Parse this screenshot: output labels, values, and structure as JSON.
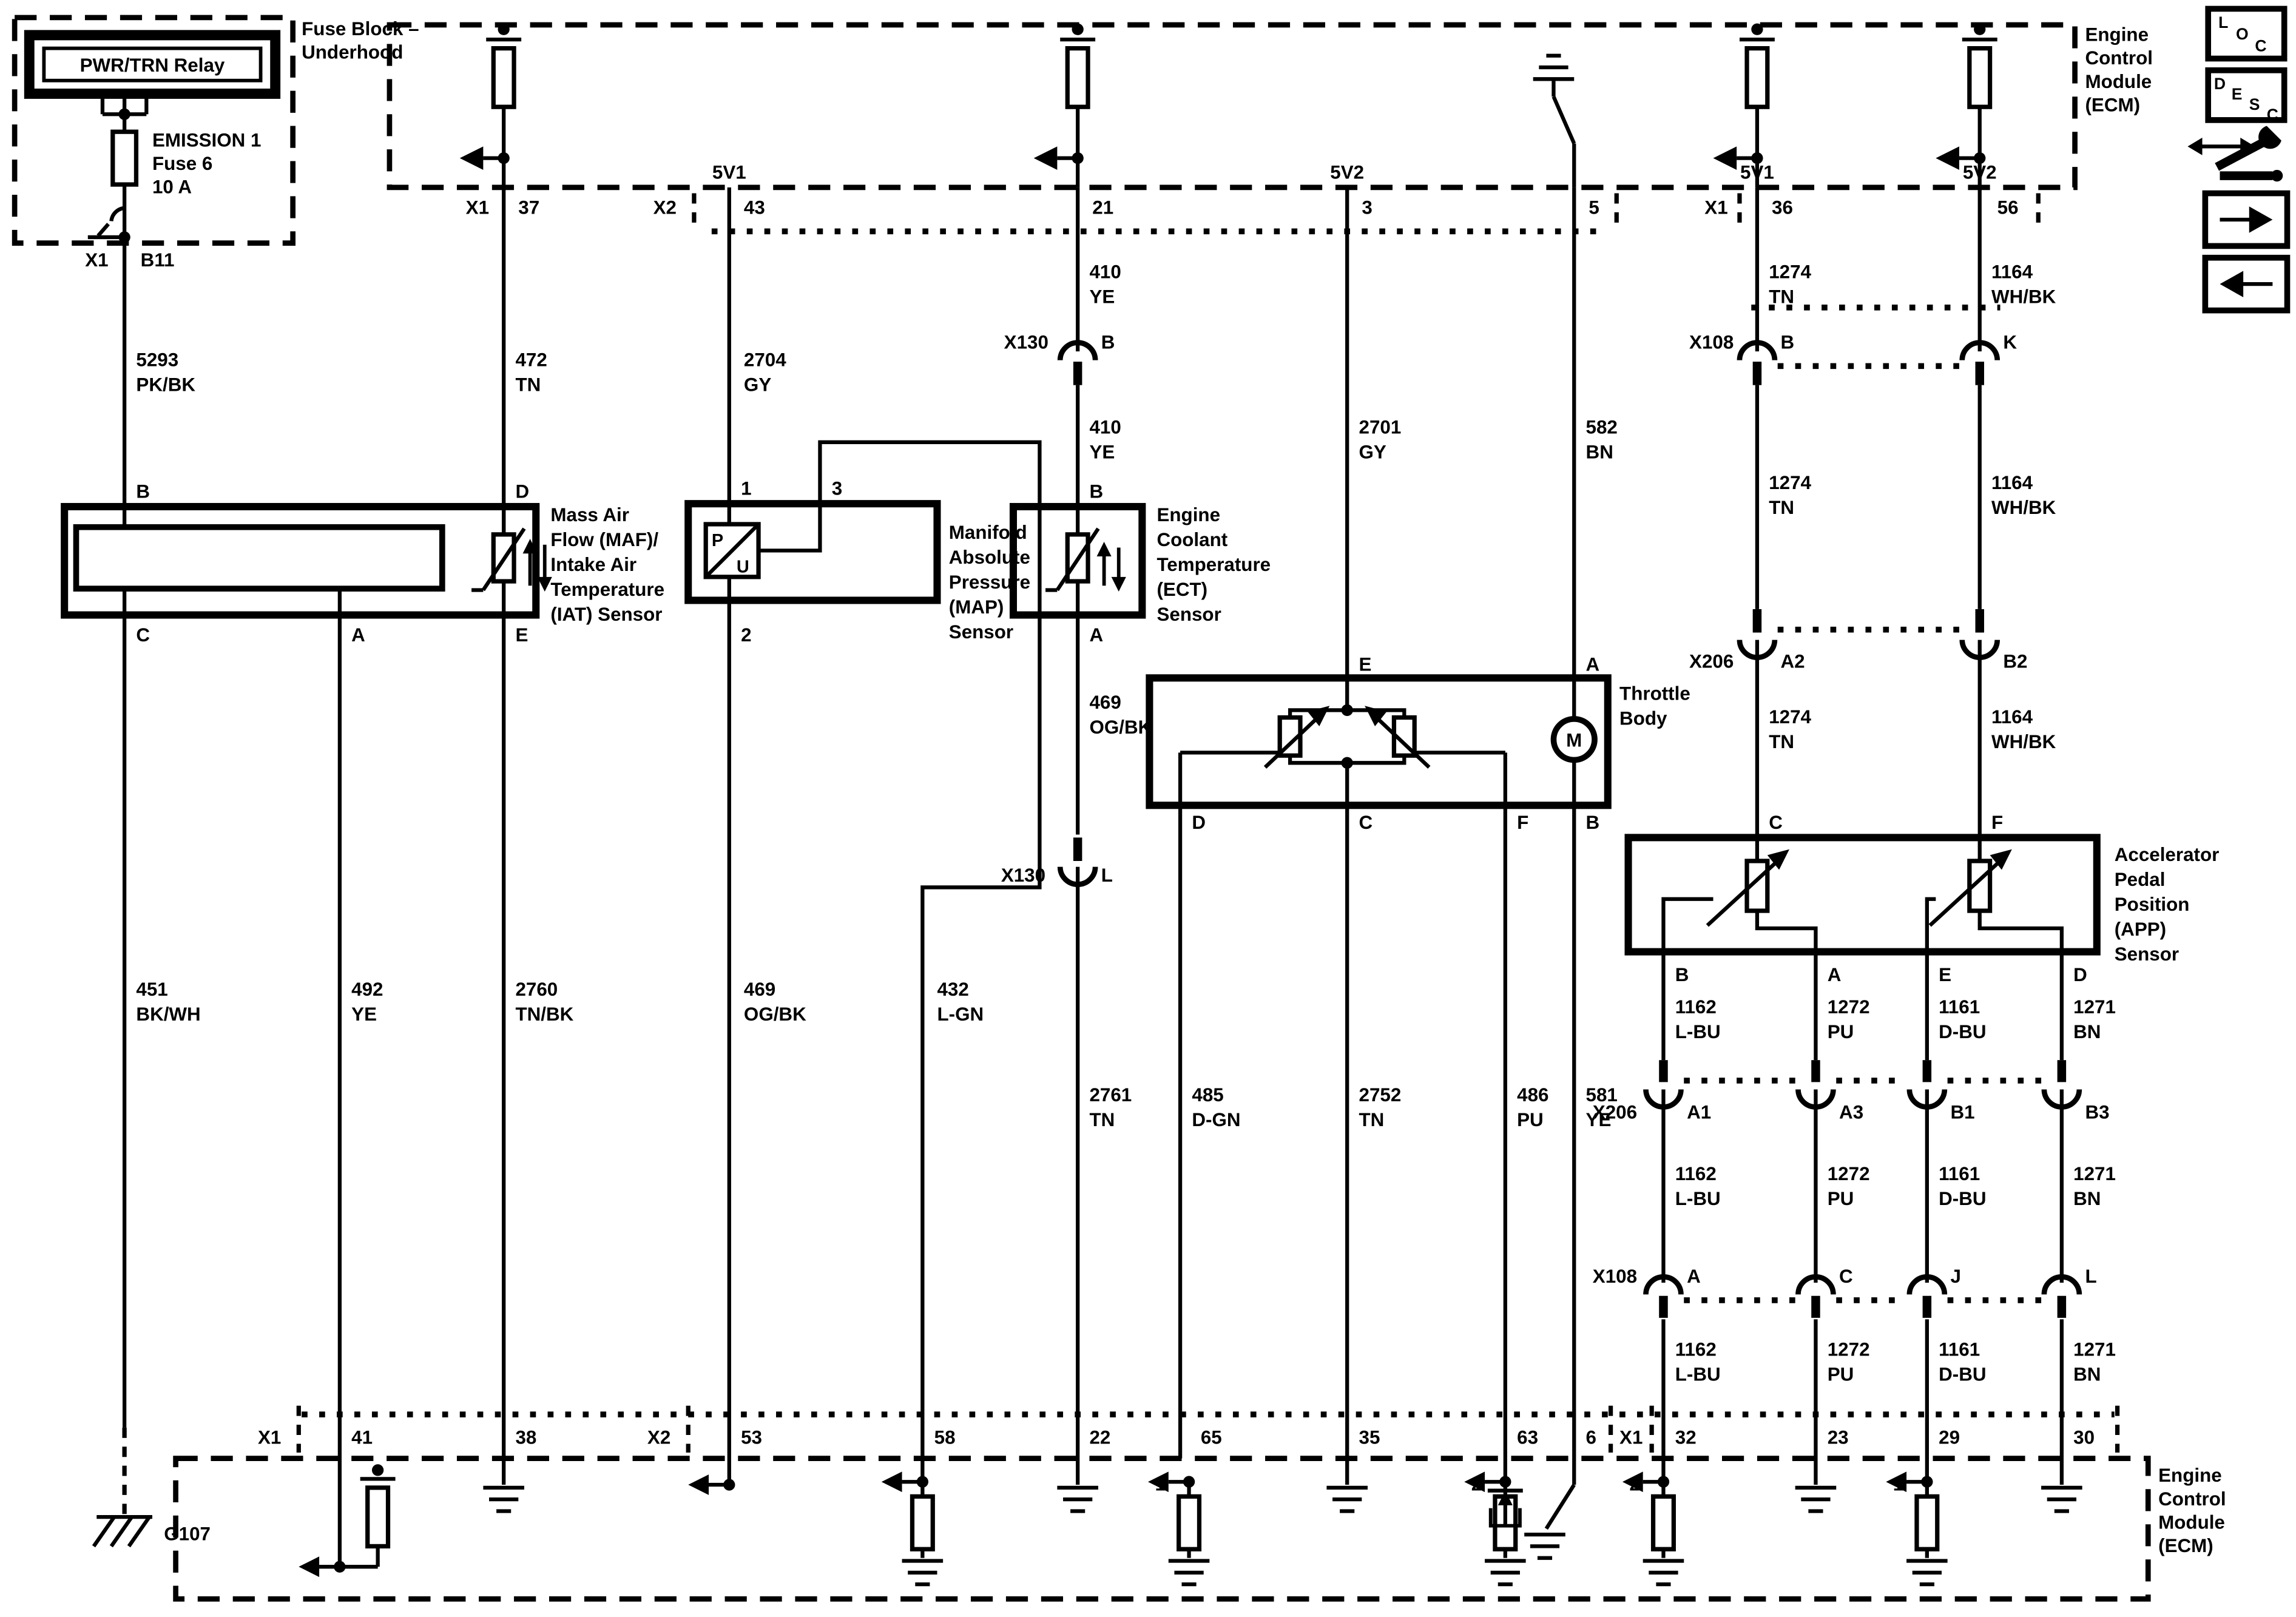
{
  "colors": {
    "ink": "#000000",
    "paper": "#ffffff"
  },
  "fuse_block": {
    "title1": "Fuse Block –",
    "title2": "Underhood",
    "relay": "PWR/TRN Relay",
    "fuse1": "EMISSION 1",
    "fuse2": "Fuse 6",
    "fuse3": "10 A",
    "conn": "X1",
    "pin": "B11"
  },
  "ecm_top": {
    "name": [
      "Engine",
      "Control",
      "Module",
      "(ECM)"
    ],
    "v1l": "5V1",
    "v2l": "5V2",
    "v1r": "5V1",
    "v2r": "5V2",
    "x1": "X1",
    "p37": "37",
    "x2": "X2",
    "p43": "43",
    "p21": "21",
    "p3": "3",
    "p5": "5",
    "x1r": "X1",
    "p36": "36",
    "p56": "56"
  },
  "ecm_bottom": {
    "name": [
      "Engine",
      "Control",
      "Module",
      "(ECM)"
    ],
    "x1": "X1",
    "p41": "41",
    "p38": "38",
    "x2": "X2",
    "p53": "53",
    "p58": "58",
    "p22": "22",
    "p65": "65",
    "p35": "35",
    "p63": "63",
    "p6": "6",
    "x1r": "X1",
    "p32": "32",
    "p23": "23",
    "p29": "29",
    "p30": "30",
    "t65": "1",
    "t63": "2",
    "t32": "2",
    "t29": "1"
  },
  "ground": {
    "label": "G107"
  },
  "maf": {
    "name": [
      "Mass Air",
      "Flow (MAF)/",
      "Intake Air",
      "Temperature",
      "(IAT) Sensor"
    ],
    "pB": "B",
    "pD": "D",
    "pC": "C",
    "pA": "A",
    "pE": "E"
  },
  "map": {
    "name": [
      "Manifold",
      "Absolute",
      "Pressure",
      "(MAP)",
      "Sensor"
    ],
    "p1": "1",
    "p3": "3",
    "p2": "2",
    "P": "P",
    "U": "U"
  },
  "ect": {
    "name": [
      "Engine",
      "Coolant",
      "Temperature",
      "(ECT)",
      "Sensor"
    ],
    "pB": "B",
    "pA": "A"
  },
  "throttle": {
    "name": [
      "Throttle",
      "Body"
    ],
    "pE": "E",
    "pA": "A",
    "pD": "D",
    "pC": "C",
    "pF": "F",
    "pB": "B",
    "m": "M"
  },
  "app": {
    "name": [
      "Accelerator",
      "Pedal",
      "Position",
      "(APP)",
      "Sensor"
    ],
    "pC": "C",
    "pF": "F",
    "pB": "B",
    "pA": "A",
    "pE": "E",
    "pD": "D"
  },
  "conn": {
    "x130b_n": "X130",
    "x130b_p": "B",
    "x130l_n": "X130",
    "x130l_p": "L",
    "x108_n": "X108",
    "x108_b": "B",
    "x108_k": "K",
    "x206_n": "X206",
    "x206_a2": "A2",
    "x206_b2": "B2",
    "x206lo_n": "X206",
    "a1": "A1",
    "a3": "A3",
    "b1": "B1",
    "b3": "B3",
    "x108lo_n": "X108",
    "xa": "A",
    "xc": "C",
    "xj": "J",
    "xl": "L"
  },
  "wires": {
    "w5293": [
      "5293",
      "PK/BK"
    ],
    "w451": [
      "451",
      "BK/WH"
    ],
    "w492": [
      "492",
      "YE"
    ],
    "w472": [
      "472",
      "TN"
    ],
    "w2760": [
      "2760",
      "TN/BK"
    ],
    "w2704": [
      "2704",
      "GY"
    ],
    "w469m": [
      "469",
      "OG/BK"
    ],
    "w432": [
      "432",
      "L-GN"
    ],
    "w410a": [
      "410",
      "YE"
    ],
    "w410b": [
      "410",
      "YE"
    ],
    "w469e": [
      "469",
      "OG/BK"
    ],
    "w2761": [
      "2761",
      "TN"
    ],
    "w2701": [
      "2701",
      "GY"
    ],
    "w2752": [
      "2752",
      "TN"
    ],
    "w485": [
      "485",
      "D-GN"
    ],
    "w486": [
      "486",
      "PU"
    ],
    "w582": [
      "582",
      "BN"
    ],
    "w581": [
      "581",
      "YE"
    ],
    "w1274a": [
      "1274",
      "TN"
    ],
    "w1274b": [
      "1274",
      "TN"
    ],
    "w1274c": [
      "1274",
      "TN"
    ],
    "w1164a": [
      "1164",
      "WH/BK"
    ],
    "w1164b": [
      "1164",
      "WH/BK"
    ],
    "w1164c": [
      "1164",
      "WH/BK"
    ],
    "w1162a": [
      "1162",
      "L-BU"
    ],
    "w1162b": [
      "1162",
      "L-BU"
    ],
    "w1162c": [
      "1162",
      "L-BU"
    ],
    "w1272a": [
      "1272",
      "PU"
    ],
    "w1272b": [
      "1272",
      "PU"
    ],
    "w1272c": [
      "1272",
      "PU"
    ],
    "w1161a": [
      "1161",
      "D-BU"
    ],
    "w1161b": [
      "1161",
      "D-BU"
    ],
    "w1161c": [
      "1161",
      "D-BU"
    ],
    "w1271a": [
      "1271",
      "BN"
    ],
    "w1271b": [
      "1271",
      "BN"
    ],
    "w1271c": [
      "1271",
      "BN"
    ]
  },
  "toolbar": {
    "loc": [
      "L",
      "O",
      "C"
    ],
    "desc": [
      "D",
      "E",
      "S",
      "C"
    ]
  }
}
